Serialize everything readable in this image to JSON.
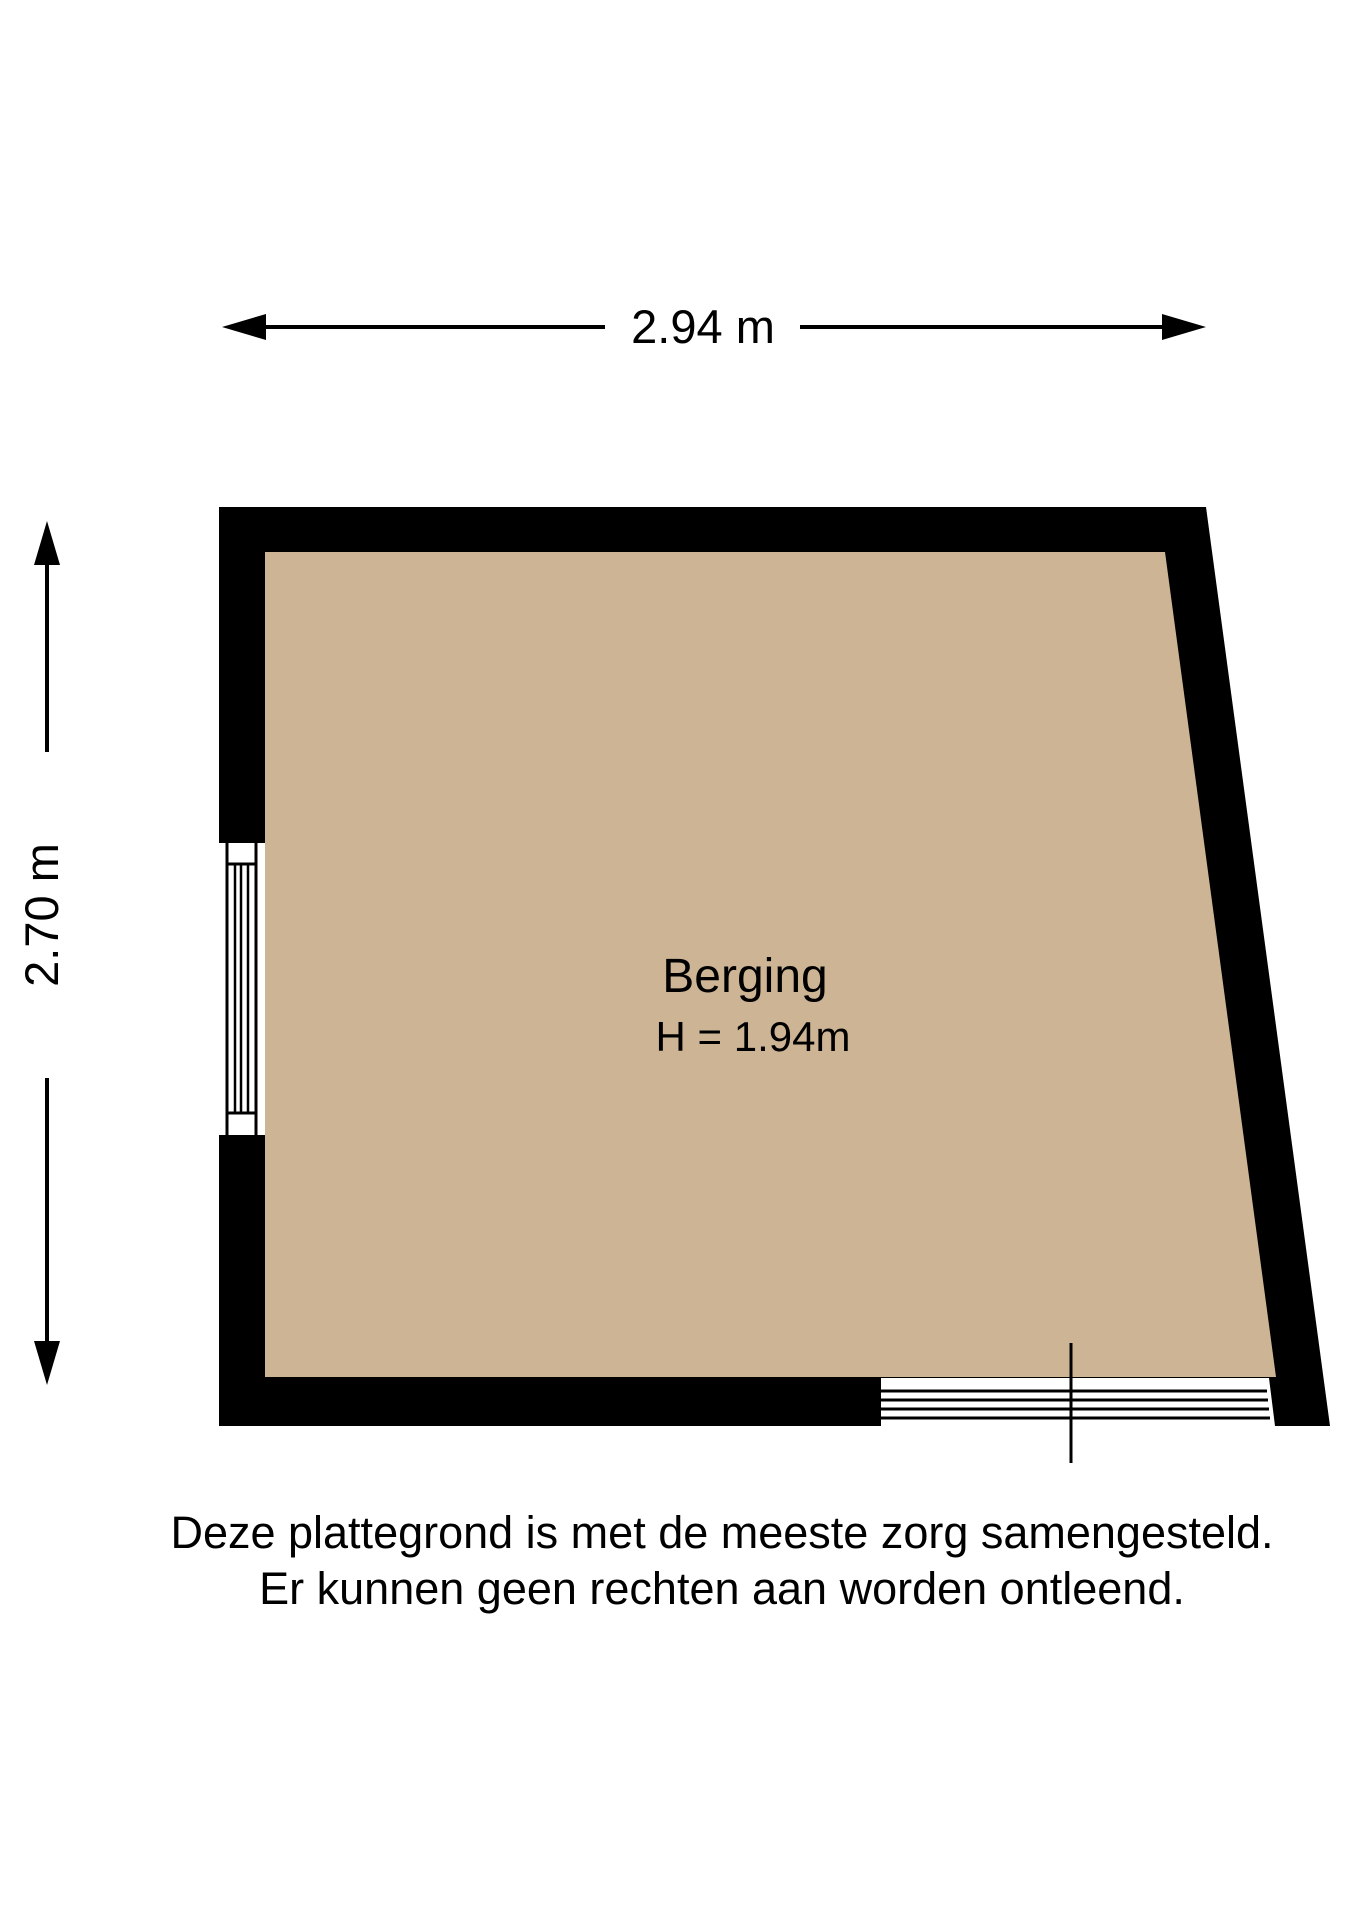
{
  "plan": {
    "room_name": "Berging",
    "room_height": "H = 1.94m",
    "width_dimension": "2.94 m",
    "height_dimension": "2.70 m"
  },
  "disclaimer": {
    "line1": "Deze plattegrond is met de meeste zorg samengesteld.",
    "line2": "Er kunnen geen rechten aan worden ontleend."
  },
  "colors": {
    "wall": "#000000",
    "floor": "#cdb494",
    "background": "#ffffff",
    "line": "#000000"
  }
}
